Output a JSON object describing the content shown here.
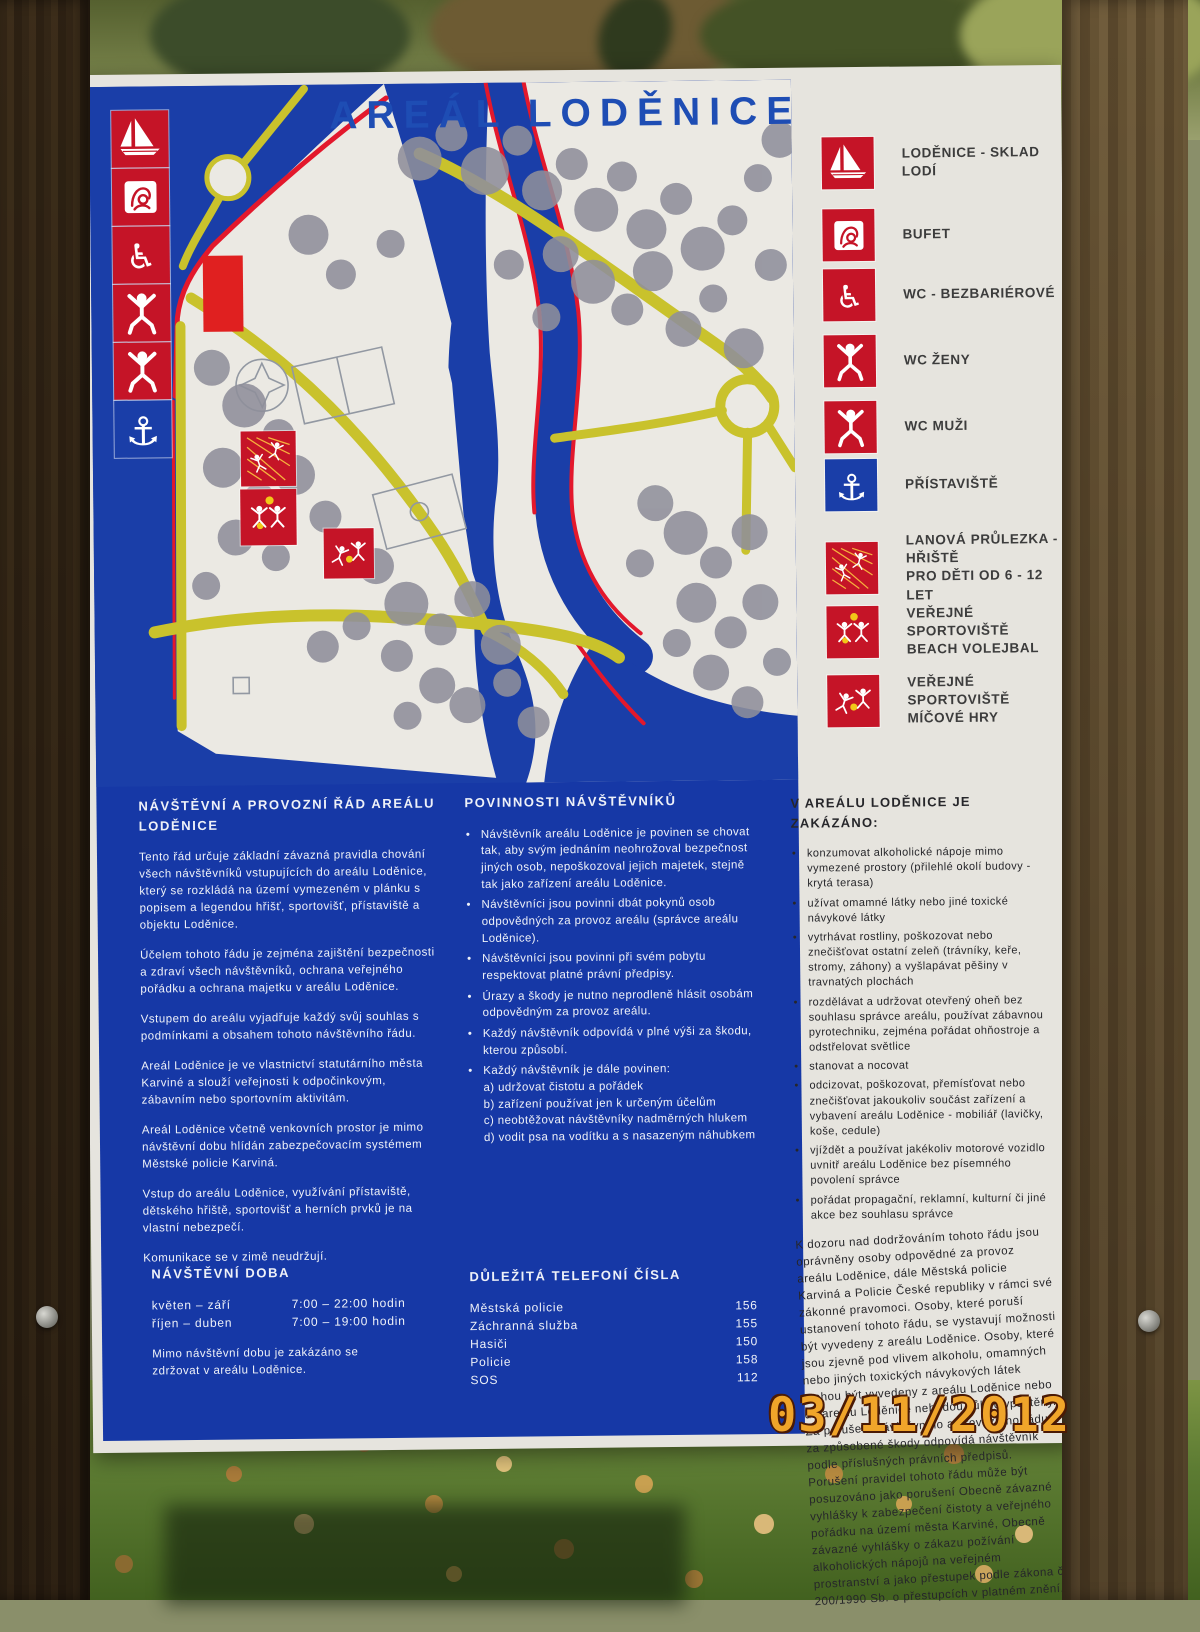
{
  "photo": {
    "date_stamp": "03/11/2012"
  },
  "sign": {
    "title": "AREÁL LODĚNICE",
    "colors": {
      "board_blue": "#1638a6",
      "marker_red": "#c51427",
      "marker_blue": "#1a3ea8",
      "path_yellow": "#c9c22c",
      "title_blue": "#1e4db4",
      "tree_gray": "#8f8f9b",
      "stamp_orange": "#f0a52a"
    },
    "map": {
      "strip_icons": [
        "sailboat-icon",
        "bufet-icon",
        "wheelchair-icon",
        "wc-woman-icon",
        "wc-man-icon",
        "anchor-icon"
      ],
      "area_markers": [
        "rope-climb-icon",
        "beach-volleyball-icon",
        "ball-games-icon"
      ]
    },
    "legend": {
      "items": [
        {
          "icon": "sailboat-icon",
          "label": "LODĚNICE - SKLAD LODÍ"
        },
        {
          "icon": "bufet-icon",
          "label": "BUFET"
        },
        {
          "icon": "wheelchair-icon",
          "label": "WC - BEZBARIÉROVÉ"
        },
        {
          "icon": "wc-woman-icon",
          "label": "WC ŽENY"
        },
        {
          "icon": "wc-man-icon",
          "label": "WC MUŽI"
        },
        {
          "icon": "anchor-icon",
          "label": "PŘÍSTAVIŠTĚ",
          "color": "#1a3ea8"
        },
        {
          "icon": "rope-climb-icon",
          "label": "LANOVÁ PRŮLEZKA - HŘIŠTĚ\nPRO DĚTI OD 6 - 12 LET"
        },
        {
          "icon": "beach-volleyball-icon",
          "label": "VEŘEJNÉ SPORTOVIŠTĚ\nBEACH VOLEJBAL"
        },
        {
          "icon": "ball-games-icon",
          "label": "VEŘEJNÉ SPORTOVIŠTĚ\nMÍČOVÉ HRY"
        }
      ]
    },
    "rules": {
      "heading": "NÁVŠTĚVNÍ A PROVOZNÍ  ŘÁD AREÁLU\nLODĚNICE",
      "paragraphs": [
        "Tento řád určuje základní závazná pravidla chování všech návštěvníků vstupujících do areálu Loděnice, který se rozkládá na území vymezeném v plánku s popisem a legendou hřišť, sportovišť, přístaviště a objektu Loděnice.",
        "Účelem tohoto řádu je zejména zajištění bezpečnosti a zdraví všech návštěvníků, ochrana veřejného pořádku a ochrana majetku v areálu Loděnice.",
        "Vstupem do areálu vyjadřuje každý svůj souhlas s podmínkami a obsahem tohoto návštěvního řádu.",
        "Areál Loděnice je ve vlastnictví statutárního města Karviné a slouží veřejnosti k odpočinkovým, zábavním nebo sportovním aktivitám.",
        "Areál Loděnice včetně venkovních prostor je mimo návštěvní dobu hlídán zabezpečovacím systémem Městské policie Karviná.",
        "Vstup do areálu Loděnice, využívání přístaviště, dětského hřiště, sportovišť a herních prvků je na vlastní nebezpečí.",
        "Komunikace se v zimě neudržují."
      ]
    },
    "duties": {
      "heading": "POVINNOSTI NÁVŠTĚVNÍKŮ",
      "bullets": [
        "Návštěvník areálu Loděnice je povinen se chovat tak, aby svým jednáním neohrožoval bezpečnost jiných osob, nepoškozoval jejich majetek, stejně tak jako zařízení areálu Loděnice.",
        "Návštěvníci jsou povinni dbát pokynů osob odpovědných za provoz areálu (správce areálu Loděnice).",
        "Návštěvníci jsou povinni při svém pobytu respektovat platné právní předpisy.",
        "Úrazy a škody je nutno neprodleně hlásit osobám odpovědným za provoz areálu.",
        "Každý návštěvník odpovídá v plné výši za škodu, kterou způsobí.",
        "Každý návštěvník je dále povinen:\na) udržovat čistotu a pořádek\nb) zařízení používat jen k určeným účelům\nc) neobtěžovat návštěvníky nadměrných hlukem\nd) vodit psa na vodítku a s nasazeným náhubkem"
      ]
    },
    "prohibitions": {
      "heading": "V AREÁLU LODĚNICE JE ZAKÁZÁNO:",
      "bullets": [
        "konzumovat alkoholické nápoje mimo vymezené prostory (přilehlé okolí budovy - krytá terasa)",
        "užívat omamné látky nebo jiné toxické návykové látky",
        "vytrhávat rostliny, poškozovat nebo znečišťovat ostatní zeleň (trávníky, keře, stromy, záhony) a vyšlapávat pěšiny v travnatých plochách",
        "rozdělávat a udržovat otevřený oheň bez souhlasu správce areálu, používat zábavnou pyrotechniku, zejména pořádat ohňostroje a odstřelovat světlice",
        "stanovat a nocovat",
        "odcizovat, poškozovat, přemísťovat nebo znečišťovat jakoukoliv součást zařízení a vybavení areálu Loděnice - mobiliář (lavičky, koše, cedule)",
        "vjíždět a používat jakékoliv motorové vozidlo uvnitř areálu Loděnice bez písemného povolení správce",
        "pořádat propagační, reklamní, kulturní či jiné akce bez souhlasu správce"
      ],
      "closing": "K dozoru nad dodržováním tohoto řádu jsou oprávněny osoby odpovědné za provoz areálu Loděnice, dále Městská policie Karviná a Policie České republiky v rámci své zákonné pravomoci. Osoby, které poruší ustanovení tohoto řádu, se vystavují možnosti být vyvedeny z areálu Loděnice. Osoby, které jsou zjevně pod vlivem alkoholu, omamných nebo jiných toxických návykových látek mohou být vyvedeny z areálu Loděnice nebo do areálu Loděnice nebudou vůbec vpuštěny. Za porušení návštěvního a provozního řádu a za způsobené škody odpovídá návštěvník podle příslušných právních předpisů. Porušení pravidel tohoto řádu může být posuzováno jako porušení Obecně závazné vyhlášky k zabezpečení čistoty a veřejného pořádku na území města Karviné, Obecně závazné vyhlášky o zákazu požívání alkoholických nápojů na veřejném prostranství a jako přestupek podle zákona č. 200/1990 Sb. o přestupcích v platném znění."
    },
    "hours": {
      "heading": "NÁVŠTĚVNÍ DOBA",
      "rows": [
        {
          "season": "květen – září",
          "time": "7:00 – 22:00 hodin"
        },
        {
          "season": "říjen – duben",
          "time": "7:00 – 19:00 hodin"
        }
      ],
      "note": "Mimo návštěvní dobu je zakázáno se\nzdržovat v areálu Loděnice."
    },
    "phones": {
      "heading": "DŮLEŽITÁ TELEFONÍ ČÍSLA",
      "rows": [
        {
          "name": "Městská policie",
          "number": "156"
        },
        {
          "name": "Záchranná služba",
          "number": "155"
        },
        {
          "name": "Hasiči",
          "number": "150"
        },
        {
          "name": "Policie",
          "number": "158"
        },
        {
          "name": "SOS",
          "number": "112"
        }
      ]
    }
  }
}
